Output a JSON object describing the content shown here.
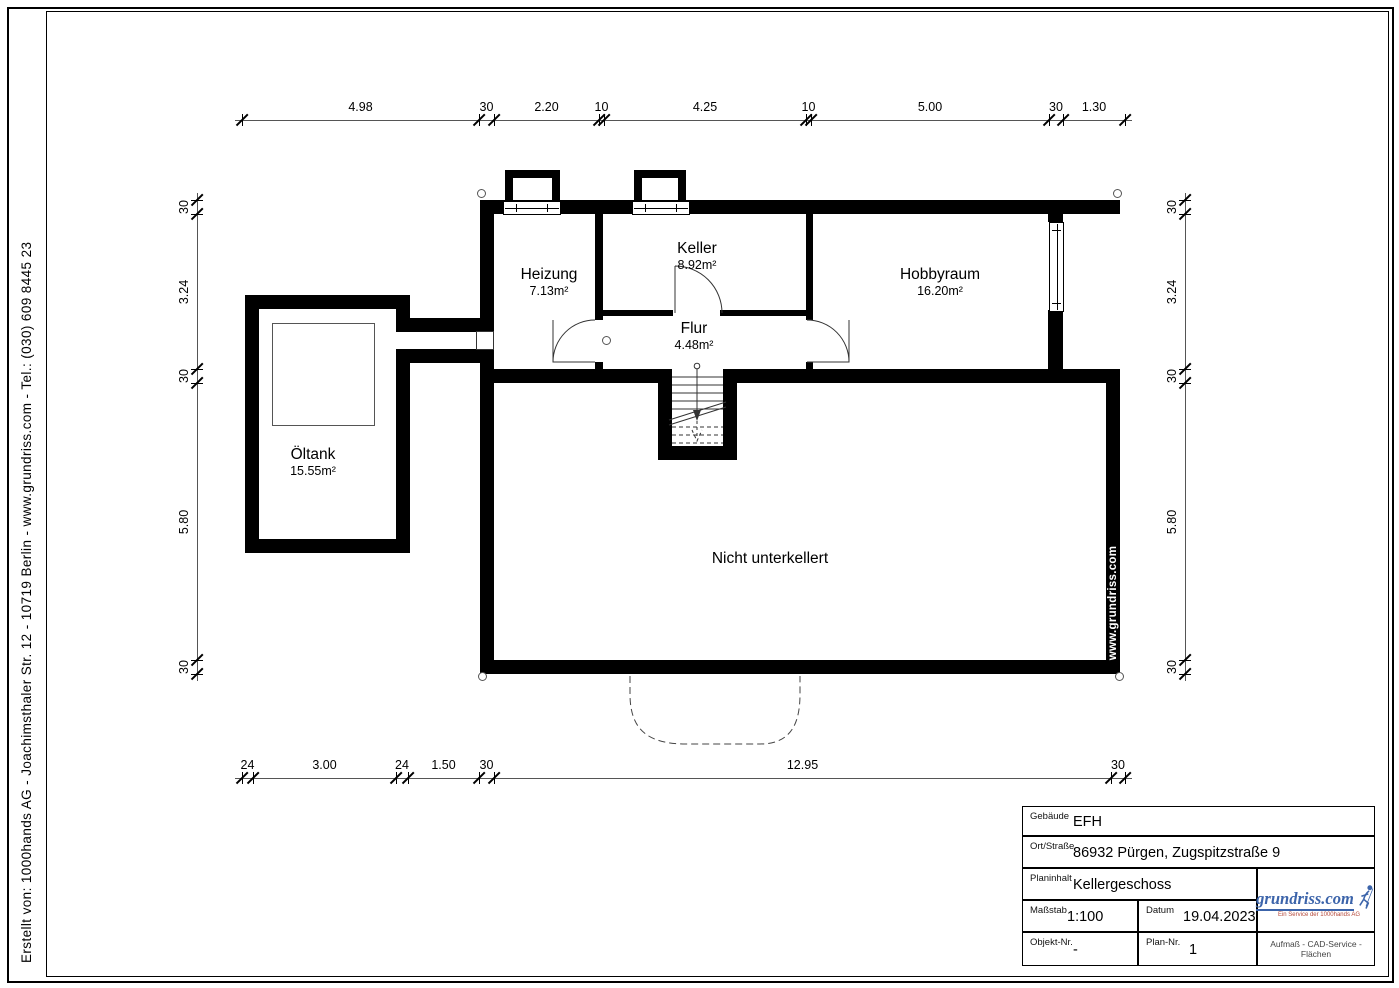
{
  "sidebar": {
    "credit_text": "Erstellt von:   1000hands AG - Joachimsthaler Str. 12 - 10719 Berlin -   www.grundriss.com   -   Tel.: (030) 609 8445 23"
  },
  "plan": {
    "rooms": [
      {
        "name": "Heizung",
        "area": "7.13m²"
      },
      {
        "name": "Keller",
        "area": "8.92m²"
      },
      {
        "name": "Hobbyraum",
        "area": "16.20m²"
      },
      {
        "name": "Flur",
        "area": "4.48m²"
      },
      {
        "name": "Öltank",
        "area": "15.55m²"
      },
      {
        "name": "Nicht unterkellert",
        "area": ""
      }
    ],
    "watermark": "www.grundriss.com"
  },
  "dimensions": {
    "top": [
      "4.98",
      "30",
      "2.20",
      "10",
      "4.25",
      "10",
      "5.00",
      "30",
      "1.30"
    ],
    "bottom": [
      "24",
      "3.00",
      "24",
      "1.50",
      "30",
      "12.95",
      "30"
    ],
    "left": [
      "30",
      "3.24",
      "30",
      "5.80",
      "30"
    ],
    "right": [
      "30",
      "3.24",
      "30",
      "5.80",
      "30"
    ]
  },
  "title_block": {
    "gebaeude_label": "Gebäude",
    "gebaeude_value": "EFH",
    "ort_label": "Ort/Straße",
    "ort_value": "86932 Pürgen, Zugspitzstraße 9",
    "planinhalt_label": "Planinhalt",
    "planinhalt_value": "Kellergeschoss",
    "massstab_label": "Maßstab",
    "massstab_value": "1:100",
    "datum_label": "Datum",
    "datum_value": "19.04.2023",
    "objekt_label": "Objekt-Nr.",
    "objekt_value": "-",
    "plan_label": "Plan-Nr.",
    "plan_value": "1",
    "logo": {
      "text": "grundriss.com",
      "subtitle": "Ein Service der 1000hands AG",
      "slogan": "Aufmaß - CAD-Service - Flächen",
      "color": "#3c64aa"
    }
  }
}
